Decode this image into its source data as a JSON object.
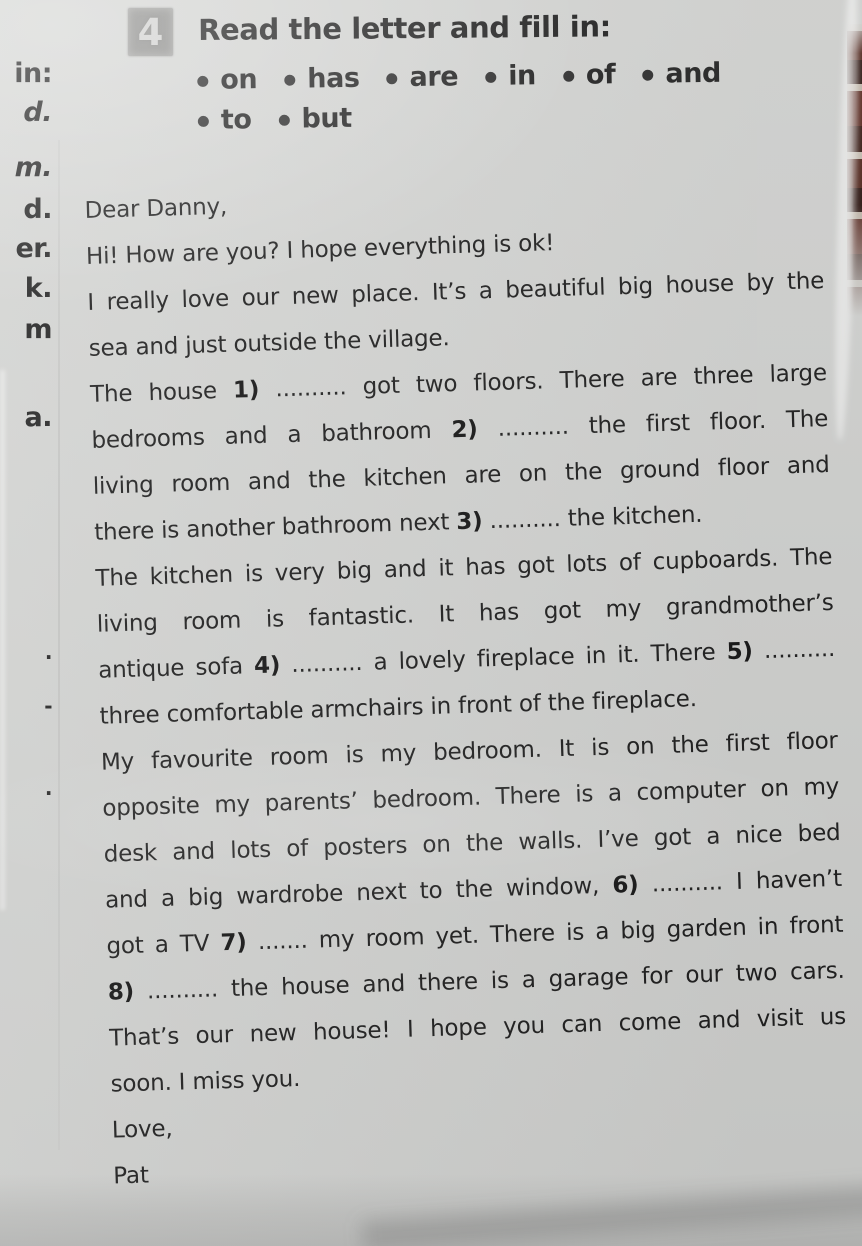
{
  "colors": {
    "paper": "#d5d6d4",
    "ink": "#1f1f1f",
    "badge_background": "#90908e",
    "badge_number": "#d3d3d1",
    "edge_pattern_dark": "#54291f",
    "edge_pattern_stripe": "#c9c0b4"
  },
  "exercise": {
    "number": "4",
    "title": "Read the letter and fill in:"
  },
  "word_bank": {
    "rows": [
      [
        "on",
        "has",
        "are",
        "in",
        "of",
        "and"
      ],
      [
        "to",
        "but"
      ]
    ]
  },
  "margin_fragments": [
    {
      "text": "in:",
      "top": 58,
      "italic": false,
      "tiny": false
    },
    {
      "text": "d.",
      "top": 97,
      "italic": true,
      "tiny": false
    },
    {
      "text": "m.",
      "top": 152,
      "italic": true,
      "tiny": false
    },
    {
      "text": "d.",
      "top": 194,
      "italic": false,
      "tiny": false
    },
    {
      "text": "er.",
      "top": 233,
      "italic": false,
      "tiny": false
    },
    {
      "text": "k.",
      "top": 273,
      "italic": false,
      "tiny": false
    },
    {
      "text": "m",
      "top": 314,
      "italic": false,
      "tiny": false
    },
    {
      "text": "a.",
      "top": 402,
      "italic": false,
      "tiny": false
    },
    {
      "text": ".",
      "top": 640,
      "italic": false,
      "tiny": true
    },
    {
      "text": "-",
      "top": 694,
      "italic": false,
      "tiny": true
    },
    {
      "text": ".",
      "top": 776,
      "italic": false,
      "tiny": true
    }
  ],
  "letter": {
    "lines": [
      {
        "align": "left",
        "segments": [
          {
            "t": "Dear Danny,"
          }
        ]
      },
      {
        "align": "left",
        "segments": [
          {
            "t": "Hi! How are you? I hope everything is ok!"
          }
        ]
      },
      {
        "align": "justify",
        "segments": [
          {
            "t": "I really love our new place. It’s a beautiful big house by the"
          }
        ]
      },
      {
        "align": "left",
        "segments": [
          {
            "t": "sea and just outside the village."
          }
        ]
      },
      {
        "align": "justify",
        "segments": [
          {
            "t": "The house "
          },
          {
            "t": "1)",
            "b": true
          },
          {
            "t": " .......... got two floors. There are three large"
          }
        ]
      },
      {
        "align": "justify",
        "segments": [
          {
            "t": "bedrooms and a bathroom "
          },
          {
            "t": "2)",
            "b": true
          },
          {
            "t": " .......... the first floor. The"
          }
        ]
      },
      {
        "align": "justify",
        "segments": [
          {
            "t": "living room and the kitchen are on the ground floor and"
          }
        ]
      },
      {
        "align": "left",
        "segments": [
          {
            "t": "there is another bathroom next "
          },
          {
            "t": "3)",
            "b": true
          },
          {
            "t": " .......... the kitchen."
          }
        ]
      },
      {
        "align": "justify",
        "segments": [
          {
            "t": "The kitchen is very big and it has got lots of cupboards. The"
          }
        ]
      },
      {
        "align": "justify",
        "segments": [
          {
            "t": "living room is fantastic. It has got my grandmother’s"
          }
        ]
      },
      {
        "align": "justify",
        "segments": [
          {
            "t": "antique sofa "
          },
          {
            "t": "4)",
            "b": true
          },
          {
            "t": " .......... a lovely fireplace in it. There "
          },
          {
            "t": "5)",
            "b": true
          },
          {
            "t": " .........."
          }
        ]
      },
      {
        "align": "left",
        "segments": [
          {
            "t": "three comfortable armchairs in front of the fireplace."
          }
        ]
      },
      {
        "align": "justify",
        "segments": [
          {
            "t": "My favourite room is my bedroom. It is on the first floor"
          }
        ]
      },
      {
        "align": "justify",
        "segments": [
          {
            "t": "opposite my parents’ bedroom. There is a computer on my"
          }
        ]
      },
      {
        "align": "justify",
        "segments": [
          {
            "t": "desk and lots of posters on the walls. I’ve got a nice bed"
          }
        ]
      },
      {
        "align": "justify",
        "segments": [
          {
            "t": "and a big wardrobe next to the window, "
          },
          {
            "t": "6)",
            "b": true
          },
          {
            "t": " .......... I haven’t"
          }
        ]
      },
      {
        "align": "justify",
        "segments": [
          {
            "t": "got a TV "
          },
          {
            "t": "7)",
            "b": true
          },
          {
            "t": " ....... my room yet. There is a big garden in front"
          }
        ]
      },
      {
        "align": "justify",
        "segments": [
          {
            "t": "8)",
            "b": true
          },
          {
            "t": " .......... the house and there is a garage for our two cars."
          }
        ]
      },
      {
        "align": "justify",
        "segments": [
          {
            "t": "That’s our new house! I hope you can come and visit us"
          }
        ]
      },
      {
        "align": "left",
        "segments": [
          {
            "t": "soon. I miss you."
          }
        ]
      },
      {
        "align": "left",
        "segments": [
          {
            "t": "Love,"
          }
        ]
      },
      {
        "align": "left",
        "segments": [
          {
            "t": "Pat"
          }
        ]
      }
    ]
  }
}
